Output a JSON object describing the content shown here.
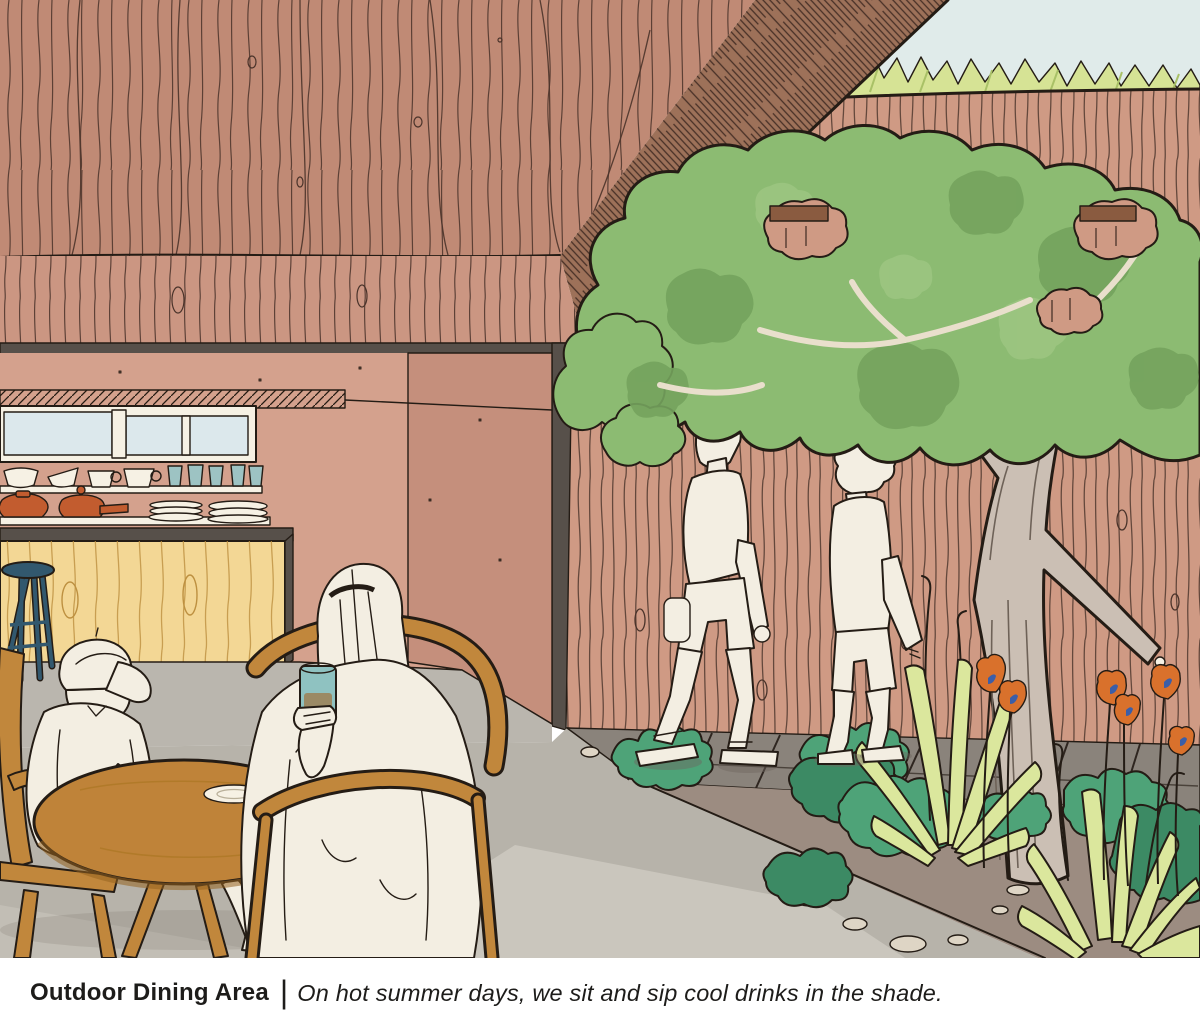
{
  "figure": {
    "alt": "Hand-drawn architectural illustration of a covered outdoor dining patio. Two people sit at a round wooden table beneath a deep wood-plank roof; a kitchen pass-through with shelves of bowls, cups and teapots and a yellow wood island is on the left; two people stroll along a wood fence beside a tree, agaves, shrubs and orange poppies on the right."
  },
  "caption": {
    "title": "Outdoor Dining Area",
    "separator": "|",
    "text": "On hot summer days, we sit and sip cool drinks in the shade."
  },
  "palette": {
    "ink": "#241c15",
    "sky": "#e0ebea",
    "grass": "#d6e395",
    "grass_dark": "#a9c167",
    "fence": "#cf9a84",
    "fence_grain": "#4a332a",
    "rail_dark": "#8a5b40",
    "roof": "#c08a75",
    "roof_edge": "#9d7159",
    "fascia": "#cb9682",
    "frame_dark": "#57504a",
    "wall": "#d4a18d",
    "door": "#c58f7c",
    "window_sky": "#dce8ec",
    "shelf": "#f6f1e4",
    "cup_teal": "#9dc3c3",
    "pot_terracotta": "#c25c2f",
    "island": "#f3d795",
    "island_grain": "#bd9040",
    "stool": "#32586e",
    "floor_in": "#bab6ae",
    "patio": "#b7b3aa",
    "patio_light": "#cac6bd",
    "path_stone": "#8a837b",
    "shadow": "#6f675f",
    "soil": "#9c8c81",
    "stone": "#ded5c5",
    "shrub": "#4ea378",
    "shrub_dark": "#3c8a64",
    "agave": "#dbe79d",
    "canopy": "#8cbb72",
    "canopy_dark": "#74a35d",
    "canopy_light": "#9cc581",
    "branch": "#e9dfcc",
    "trunk": "#cbbfb4",
    "trunk_line": "#6e6258",
    "poppy": "#d9712c",
    "poppy_center": "#3b5ea8",
    "furniture": "#c1873c",
    "table_top": "#bf8339",
    "table_edge": "#96621f",
    "skin": "#f3eee2",
    "drink": "#9b8a65",
    "glass": "#8fc2c1"
  }
}
